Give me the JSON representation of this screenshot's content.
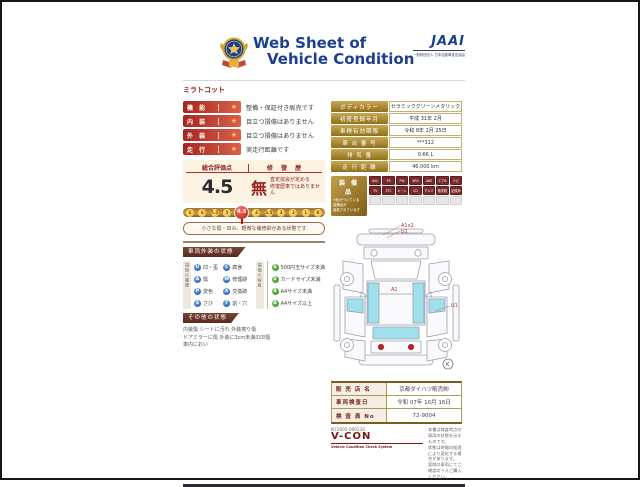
{
  "colors": {
    "header_blue": "#1c3f90",
    "maroon": "#8a2424",
    "label_red": "#c0392b",
    "gold_label": "#9a7a28",
    "glass_cyan": "#9fe0ec",
    "badge_red": "#7a2828",
    "scale_gold": "#c49a48",
    "selected_red": "#bc1414"
  },
  "header": {
    "title_line1": "Web Sheet of",
    "title_line2": "Vehicle Condition",
    "jaai_logo": "JAAI",
    "jaai_subtitle": "一般財団法人 日本自動車査定協会",
    "model_name": "ミラトコット"
  },
  "condition_rows": [
    {
      "label": "機 能",
      "star": "★",
      "text": "整備・保証付き販売です"
    },
    {
      "label": "内 装",
      "star": "★",
      "text": "目立つ損傷はありません"
    },
    {
      "label": "外 装",
      "star": "★",
      "text": "目立つ損傷はありません"
    },
    {
      "label": "走 行",
      "star": "★",
      "text": "実走行距離です"
    }
  ],
  "evaluation": {
    "score_label": "総合評価点",
    "repair_label": "修 復 歴",
    "score": "4.5",
    "repair_value": "無",
    "repair_note": "査定協会が定める\n修復歴車ではありません",
    "scale": [
      "S",
      "6",
      "5.5",
      "5",
      "4.5",
      "4",
      "3.5",
      "3",
      "2",
      "1",
      "R"
    ],
    "scale_selected": "4.5",
    "caption": "小さな傷・凹み、軽微な補修跡がある状態です"
  },
  "vehicle_info": {
    "rows": [
      {
        "label": "ボディカラー",
        "value": "セラミックグリーンメタリック"
      },
      {
        "label": "初度登録年月",
        "value": "平成 31年 2月"
      },
      {
        "label": "車検有効期限",
        "value": "令和 8年 2月 25日"
      },
      {
        "label": "車 台 番 号",
        "value": "***312"
      },
      {
        "label": "排 気 量",
        "value": "0.66 L"
      },
      {
        "label": "走 行 距 離",
        "value": "46,000 km"
      }
    ]
  },
  "equipment": {
    "title": "装 備 品",
    "note": "※色がついている\n装備品が\n装着されています",
    "badges_active": [
      "AAC",
      "PS",
      "PW",
      "SRS",
      "ABS",
      "エアB",
      "ナビ",
      "TV",
      "ETC",
      "キーレス",
      "CD",
      "アルミ",
      "衝突軽減",
      "記録簿"
    ],
    "badges_empty_count": 7
  },
  "exterior_legend": {
    "section_title": "車両外装の状態",
    "type_label": "損傷の種類",
    "types": [
      {
        "code": "U",
        "text": "凹・歪"
      },
      {
        "code": "C",
        "text": "腐食"
      },
      {
        "code": "A",
        "text": "傷"
      },
      {
        "code": "W",
        "text": "修理跡"
      },
      {
        "code": "P",
        "text": "変色"
      },
      {
        "code": "X",
        "text": "交換跡"
      },
      {
        "code": "S",
        "text": "さび"
      },
      {
        "code": "T",
        "text": "割・穴"
      }
    ],
    "degree_label": "損傷の程度",
    "degrees": [
      {
        "code": "1",
        "text": "500円玉サイズ未満"
      },
      {
        "code": "2",
        "text": "カードサイズ未満"
      },
      {
        "code": "3",
        "text": "A4サイズ未満"
      },
      {
        "code": "4",
        "text": "A4サイズ以上"
      }
    ]
  },
  "other_condition": {
    "section_title": "その他の状態",
    "lines": "内装傷 シートに汚れ 外装擦り傷\nドアミラーに傷 外装に3cm未満の凹傷\n車内におい"
  },
  "diagram": {
    "annotation_top_line1": "A1x2",
    "annotation_top_line2": "U1",
    "roof_label": "A1",
    "right_label": "U1",
    "corner_label": "K"
  },
  "dealer": {
    "rows": [
      {
        "label": "販 売 店 名",
        "value": "京都ダイハツ販売㈱"
      },
      {
        "label": "車両検査日",
        "value": "令和 07年 10月 16日"
      },
      {
        "label": "検 査 員 No",
        "value": "72-9004"
      }
    ]
  },
  "footer": {
    "doc_number": "N72005-000234",
    "vcon": "V-CON",
    "vcon_sub": "Vehicle Condition Check System",
    "disclaimer": "本書は検査時点の車両の状態を示すものです。\n状態は時間の経過により変化する場合があります。\n実際の車両にてご確認のうえご購入ください。"
  }
}
